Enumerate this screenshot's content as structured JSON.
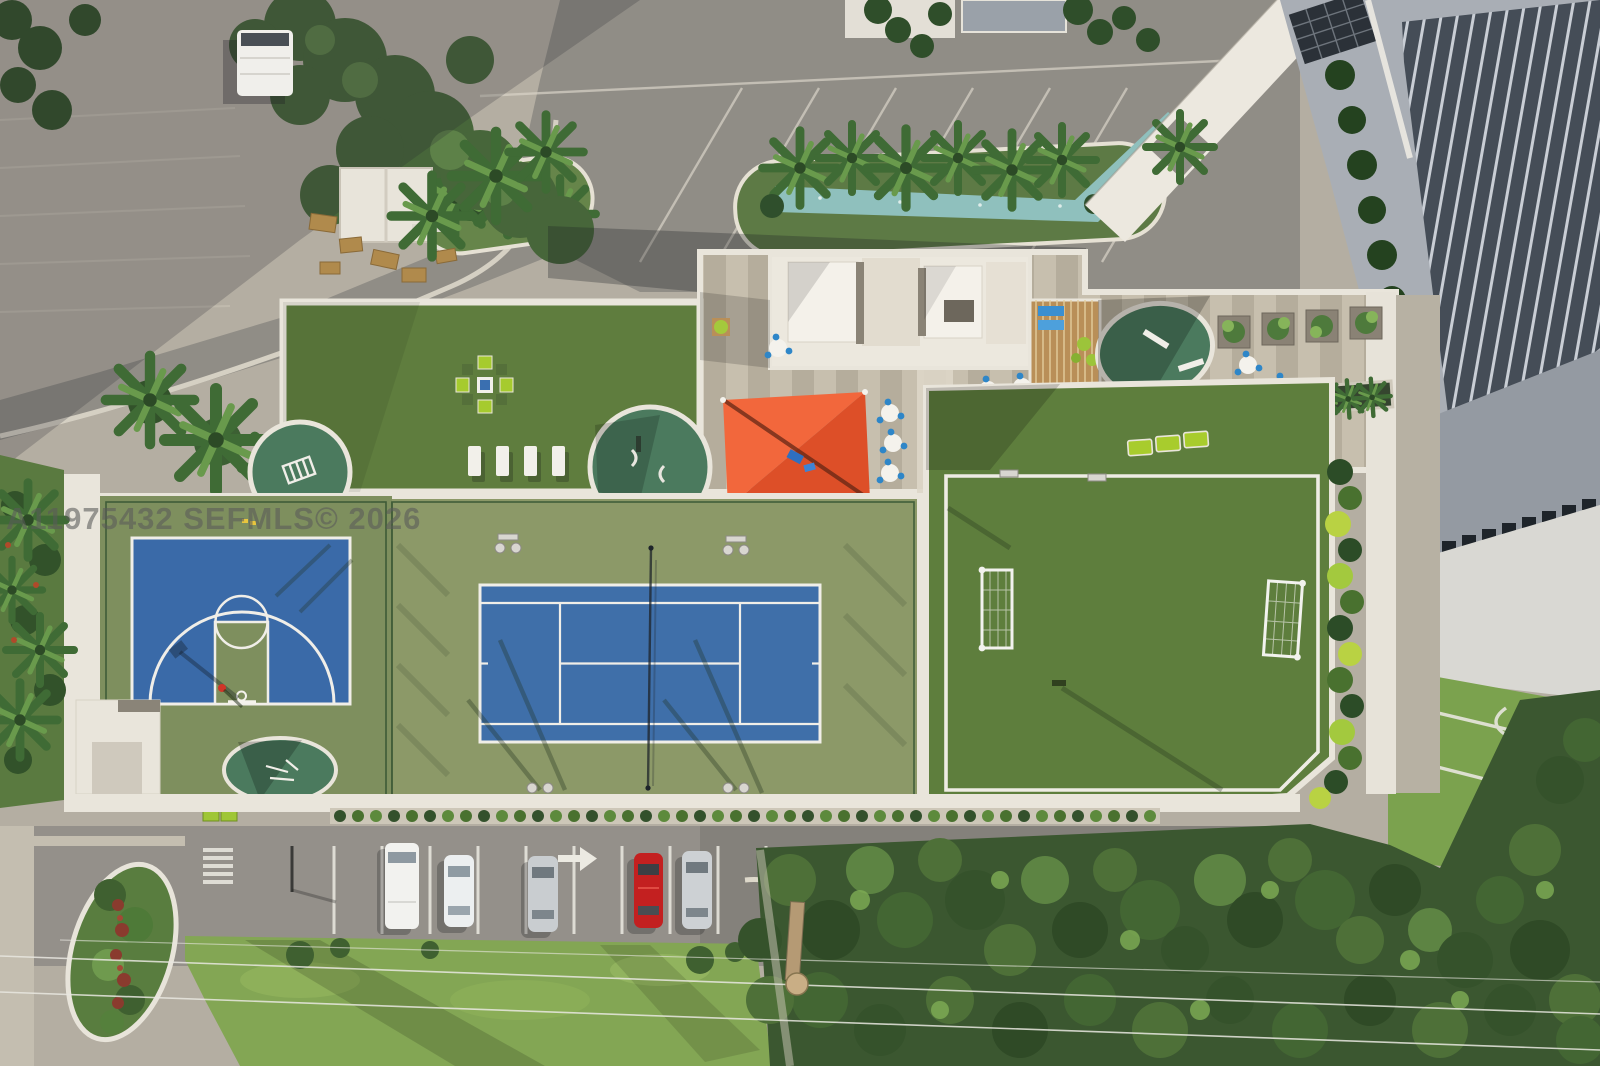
{
  "meta": {
    "title": "Aerial drone photograph of a condominium amenity deck with sports courts",
    "image_width": 1600,
    "image_height": 1066
  },
  "watermark": {
    "text": "A11975432  SEFMLS© 2026",
    "color": "#5a5a5a",
    "opacity": 0.58,
    "font_size_px": 31,
    "position": {
      "x": 6,
      "y": 529
    }
  },
  "palette": {
    "pavement_light": "#b4aea2",
    "road_gray": "#908d86",
    "deck_white": "#e9e5db",
    "deck_stripe_a": "#c7bfae",
    "deck_stripe_b": "#b5ad9c",
    "turf_green": "#5f7d3e",
    "soccer_green": "#5e7e3d",
    "tennis_blue": "#3f6fa9",
    "basketball_blue": "#3a6aa8",
    "tennis_apron": "#8c9968",
    "basketball_apron": "#7e8f5e",
    "fitness_pad_green": "#4b7a5e",
    "shade_sail_orange": "#ef5c32",
    "lime_furniture": "#a8cc2d",
    "pool_teal": "#8fc0bd",
    "pergola_wood": "#b98f58",
    "hedge_dark": "#33512c",
    "tree_dark": "#3b5730",
    "tree_light": "#5d8443",
    "grass_verge": "#83a654",
    "tower_roof_slats": "#454d57",
    "tower_roof_gray": "#949aa2",
    "facade_white": "#d9d8d3",
    "car_red": "#c32020",
    "cafe_chair_blue": "#2e86c8"
  },
  "scene": {
    "elements": [
      "tower-roof",
      "porte-cochere-canopy",
      "reflecting-pool",
      "palm-islands",
      "upper-parking-lot",
      "white-box-truck",
      "maintenance-shed",
      "pallet-stack",
      "amenity-deck",
      "turf-lawn",
      "lime-chair-cluster",
      "white-loungers",
      "orange-shade-sail",
      "kids-play-area",
      "wood-pergola",
      "cafe-tables",
      "fitness-pads",
      "planter-row",
      "basketball-half-court",
      "player-person",
      "tennis-court",
      "tennis-net",
      "court-lighting",
      "soccer-field",
      "soccer-goals",
      "lime-loungers",
      "deck-hedge",
      "street-parking",
      "parked-cars",
      "pavement-arrow",
      "crosswalk",
      "grass-verge",
      "power-lines",
      "utility-pole",
      "landscaped-island",
      "tree-canopy"
    ],
    "parked_cars": [
      {
        "type": "box-van",
        "color": "white"
      },
      {
        "type": "sedan",
        "color": "white"
      },
      {
        "type": "sedan",
        "color": "silver"
      },
      {
        "type": "sedan",
        "color": "red"
      },
      {
        "type": "sedan",
        "color": "silver"
      }
    ],
    "cafe_table_count": 9,
    "white_lounger_count": 4,
    "lime_lounger_count": 3,
    "soccer_goal_count": 2
  }
}
